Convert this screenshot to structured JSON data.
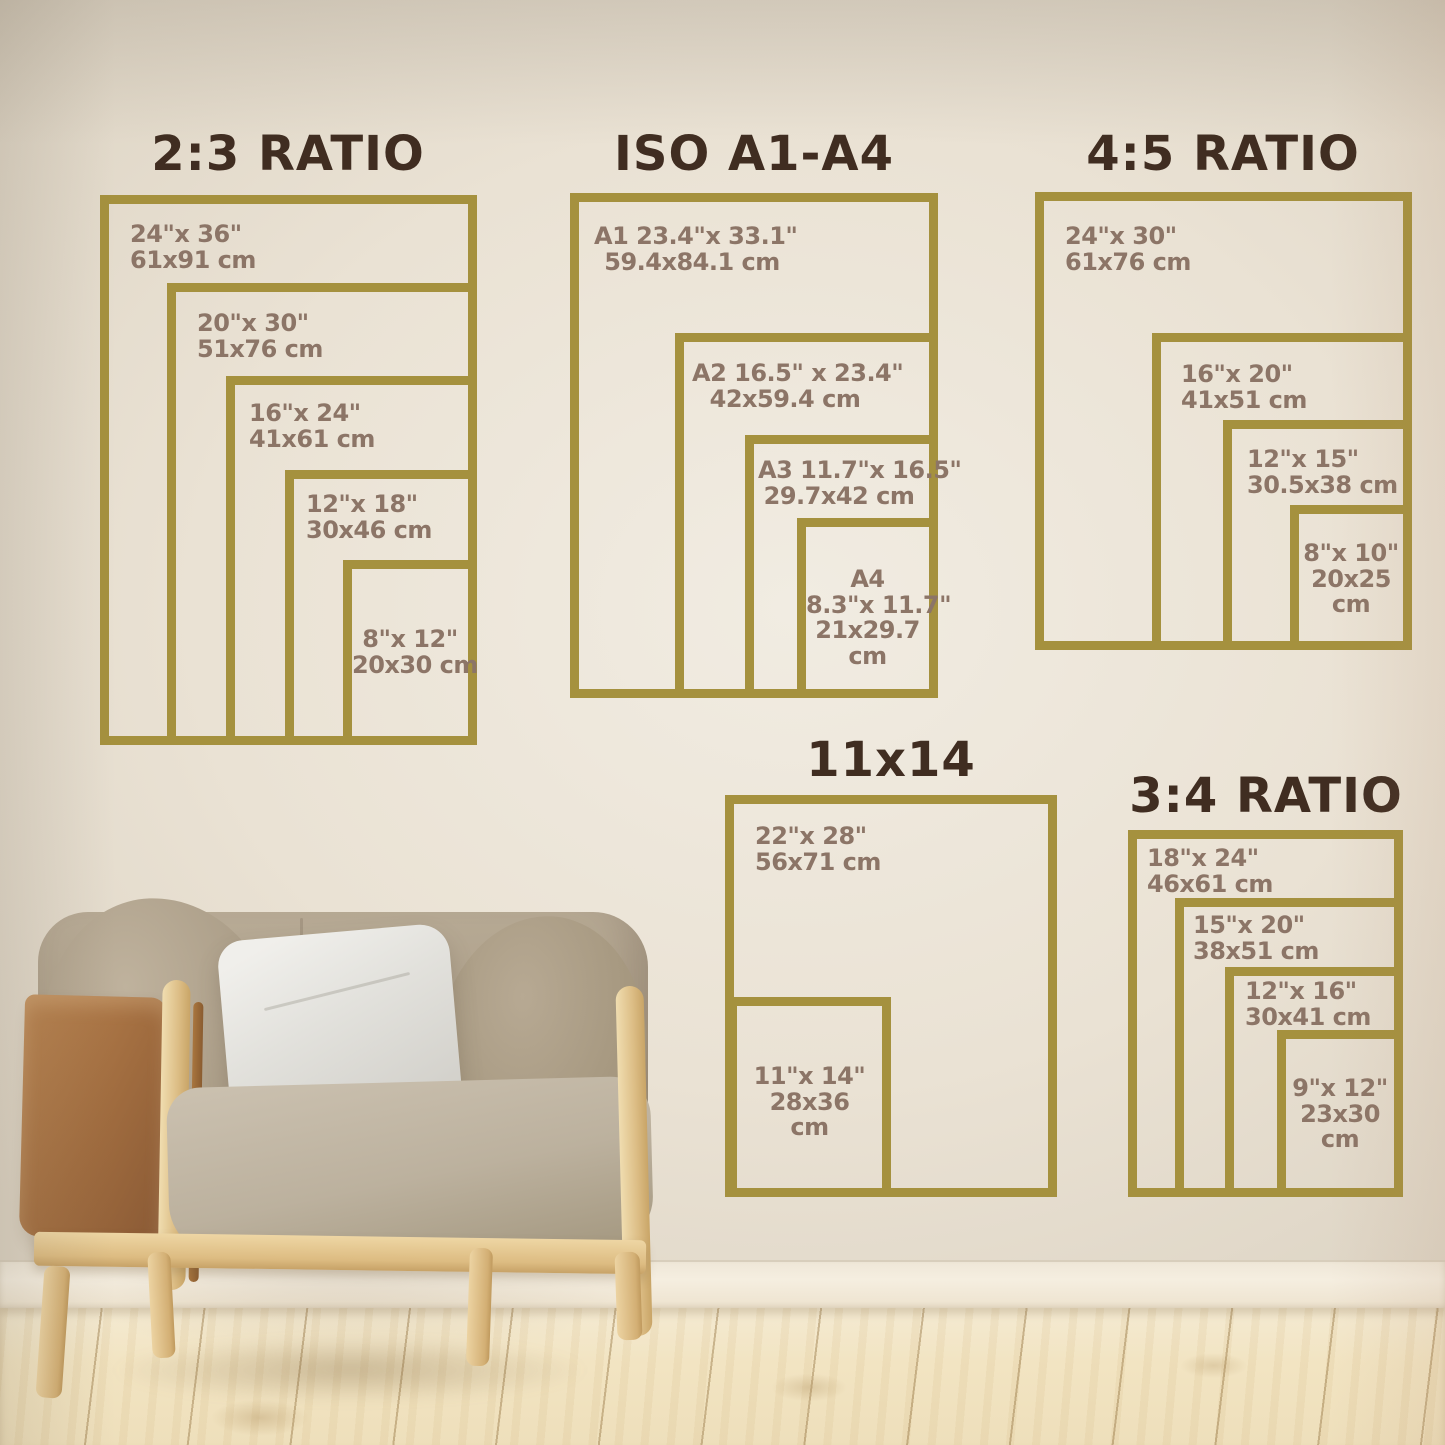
{
  "groups": [
    {
      "title": "2:3 RATIO",
      "sizes": [
        {
          "lines": [
            "24\"x 36\"",
            "61x91 cm"
          ]
        },
        {
          "lines": [
            "20\"x 30\"",
            "51x76 cm"
          ]
        },
        {
          "lines": [
            "16\"x 24\"",
            "41x61 cm"
          ]
        },
        {
          "lines": [
            "12\"x 18\"",
            "30x46 cm"
          ]
        },
        {
          "lines": [
            "8\"x 12\"",
            "20x30 cm"
          ]
        }
      ]
    },
    {
      "title": "ISO A1-A4",
      "sizes": [
        {
          "lines": [
            "A1 23.4\"x 33.1\"",
            "59.4x84.1 cm"
          ]
        },
        {
          "lines": [
            "A2 16.5\" x 23.4\"",
            "42x59.4 cm"
          ]
        },
        {
          "lines": [
            "A3 11.7\"x 16.5\"",
            "29.7x42 cm"
          ]
        },
        {
          "lines": [
            "A4",
            "8.3\"x 11.7\"",
            "21x29.7",
            "cm"
          ]
        }
      ]
    },
    {
      "title": "4:5 RATIO",
      "sizes": [
        {
          "lines": [
            "24\"x 30\"",
            "61x76 cm"
          ]
        },
        {
          "lines": [
            "16\"x 20\"",
            "41x51 cm"
          ]
        },
        {
          "lines": [
            "12\"x 15\"",
            "30.5x38 cm"
          ]
        },
        {
          "lines": [
            "8\"x 10\"",
            "20x25",
            "cm"
          ]
        }
      ]
    },
    {
      "title": "11x14",
      "sizes": [
        {
          "lines": [
            "22\"x 28\"",
            "56x71 cm"
          ]
        },
        {
          "lines": [
            "11\"x 14\"",
            "28x36",
            "cm"
          ]
        }
      ]
    },
    {
      "title": "3:4 RATIO",
      "sizes": [
        {
          "lines": [
            "18\"x 24\"",
            "46x61 cm"
          ]
        },
        {
          "lines": [
            "15\"x 20\"",
            "38x51 cm"
          ]
        },
        {
          "lines": [
            "12\"x 16\"",
            "30x41 cm"
          ]
        },
        {
          "lines": [
            "9\"x 12\"",
            "23x30",
            "cm"
          ]
        }
      ]
    }
  ],
  "colors": {
    "frame_border": "#a5913e",
    "title_text": "#402d21",
    "label_text": "#8c7567",
    "wall": "#eae2d4",
    "baseboard": "#f3ecdd",
    "floor_wood": "#f2e5c6",
    "chair_fabric": "#b2a48d",
    "chair_pillow": "#e9e8e3",
    "chair_leather": "#a26e41",
    "chair_wood": "#e3c795"
  }
}
